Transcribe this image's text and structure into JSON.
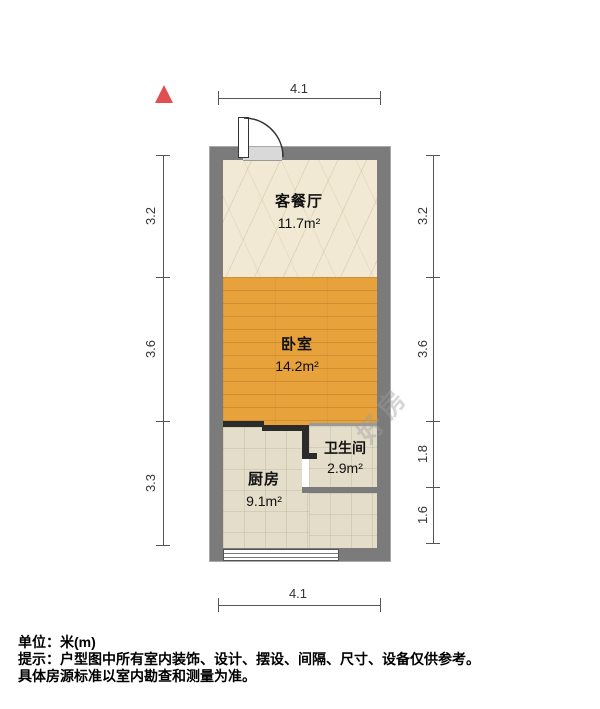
{
  "plan": {
    "rooms": [
      {
        "name": "客餐厅",
        "area": "11.7m²"
      },
      {
        "name": "卧室",
        "area": "14.2m²"
      },
      {
        "name": "厨房",
        "area": "9.1m²"
      },
      {
        "name": "卫生间",
        "area": "2.9m²"
      }
    ],
    "dimensions": {
      "top": "4.1",
      "bottom": "4.1",
      "left": [
        "3.2",
        "3.6",
        "3.3"
      ],
      "right": [
        "3.2",
        "3.6",
        "1.8",
        "1.6"
      ]
    },
    "watermark": "好房"
  },
  "footer": {
    "unit": "单位：米(m)",
    "notice": "提示：户型图中所有室内装饰、设计、摆设、间隔、尺寸、设备仅供参考。",
    "notice2": "具体房源标准以室内勘查和测量为准。"
  },
  "colors": {
    "outer_wall": "#7b7b7b",
    "interior_wall": "#2b2b2b",
    "living_floor": "#f1e9d4",
    "bedroom_floor": "#e7a23c",
    "kitchen_floor": "#e3ddc9",
    "north_arrow": "#e05050",
    "dimension_line": "#555555"
  }
}
